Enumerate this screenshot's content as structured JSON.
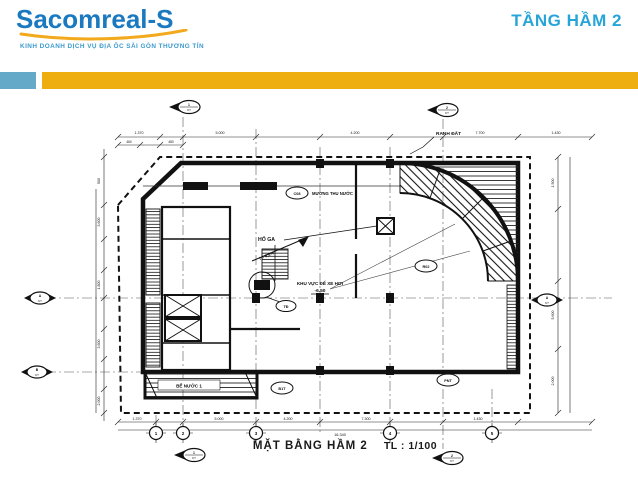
{
  "header": {
    "brand": "Sacomreal-S",
    "tagline": "KINH DOANH DỊCH VỤ ĐỊA ỐC SÀI GÒN THƯƠNG TÍN",
    "title": "TẦNG HẦM 2",
    "colors": {
      "brand_blue": "#1B79C0",
      "title_cyan": "#27A5D8",
      "bar_yellow": "#EFAE0F",
      "block_teal": "#64A9C8"
    }
  },
  "plan": {
    "caption": {
      "title": "MẶT BẰNG HẦM 2",
      "scale": "TL : 1/100"
    },
    "labels": {
      "boundary": "RANH ĐẤT",
      "channel_code": "C08",
      "channel": "MƯƠNG THU NƯỚC",
      "pit": "HỐ GA",
      "slope": "i = 6,5%",
      "parking": "KHU VỰC ĐỂ XE HƠI",
      "level": "-6.50",
      "tank": "BỂ NƯỚC 1",
      "tank_code": "B1T",
      "equip_code": "TĐ",
      "ramp_code": "R02",
      "pump_code": "PNT"
    },
    "dimensions": {
      "top": [
        "1.370",
        "5.000",
        "4.200",
        "7.700",
        "1.430"
      ],
      "top_sub": [
        "460",
        "480"
      ],
      "left": [
        "500",
        "3.600",
        "1.800",
        "3.600",
        "2.000"
      ],
      "right": [
        "1.500",
        "5.600",
        "2.000"
      ],
      "bottom": [
        "1.370",
        "5.000",
        "4.200",
        "7.300",
        "1.430"
      ],
      "bottom_total": "16.340"
    },
    "grid_bubbles": [
      "1",
      "2",
      "3",
      "4",
      "5"
    ],
    "markers": [
      {
        "num": "1",
        "sheet": "KT"
      },
      {
        "num": "2",
        "sheet": "KT"
      },
      {
        "num": "A",
        "sheet": "KT"
      },
      {
        "num": "B",
        "sheet": "KT"
      },
      {
        "num": "A",
        "sheet": "KT"
      },
      {
        "num": "1",
        "sheet": "KT"
      },
      {
        "num": "2",
        "sheet": "KT"
      }
    ]
  }
}
